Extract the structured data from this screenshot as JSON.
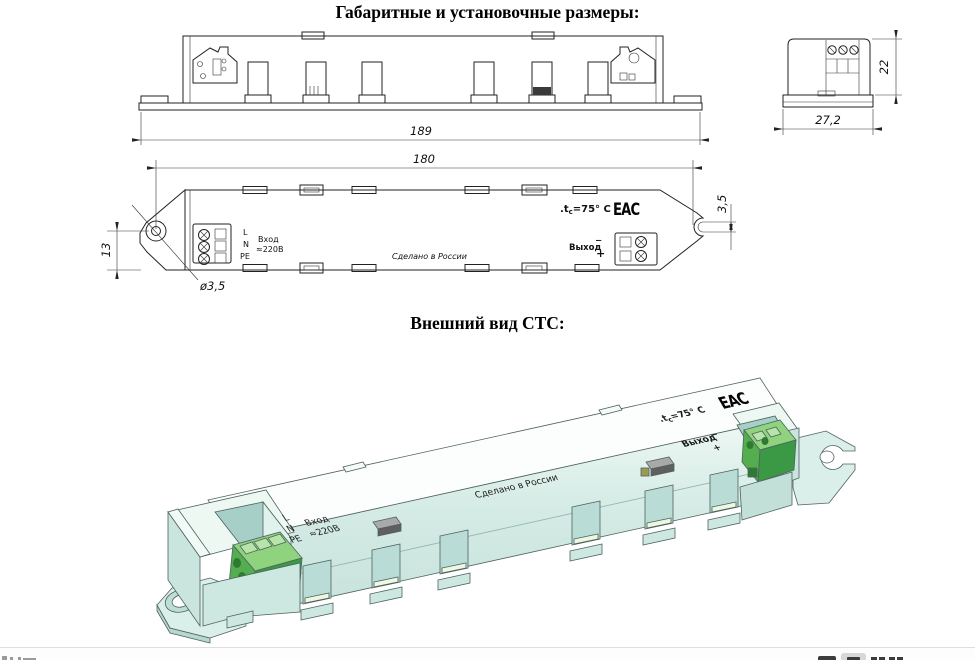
{
  "titles": {
    "dimensions": "Габаритные и установочные размеры:",
    "appearance": "Внешний вид СТС:"
  },
  "dims": {
    "overall_length": "189",
    "overall_width": "27,2",
    "height": "22",
    "mounting_length": "180",
    "hole_offset": "13",
    "hole_diameter": "ø3,5",
    "slot_width": "3,5"
  },
  "labels": {
    "line": "L",
    "neutral": "N",
    "pe": "PE",
    "input": "Вход",
    "input_voltage": "≈220В",
    "made_in": "Сделано в России",
    "tc_dot": ".",
    "tc_symbol": "t",
    "tc_sub": "c",
    "tc_value": "=75° C",
    "eac_mark": "EAC",
    "output": "Выход",
    "output_minus": "−",
    "output_plus": "+"
  },
  "colors": {
    "body_teal": "#cfe8e2",
    "top_white": "#fbfdfc",
    "terminal_green": "#4aa348",
    "drawing_line": "#1a1a1a"
  }
}
